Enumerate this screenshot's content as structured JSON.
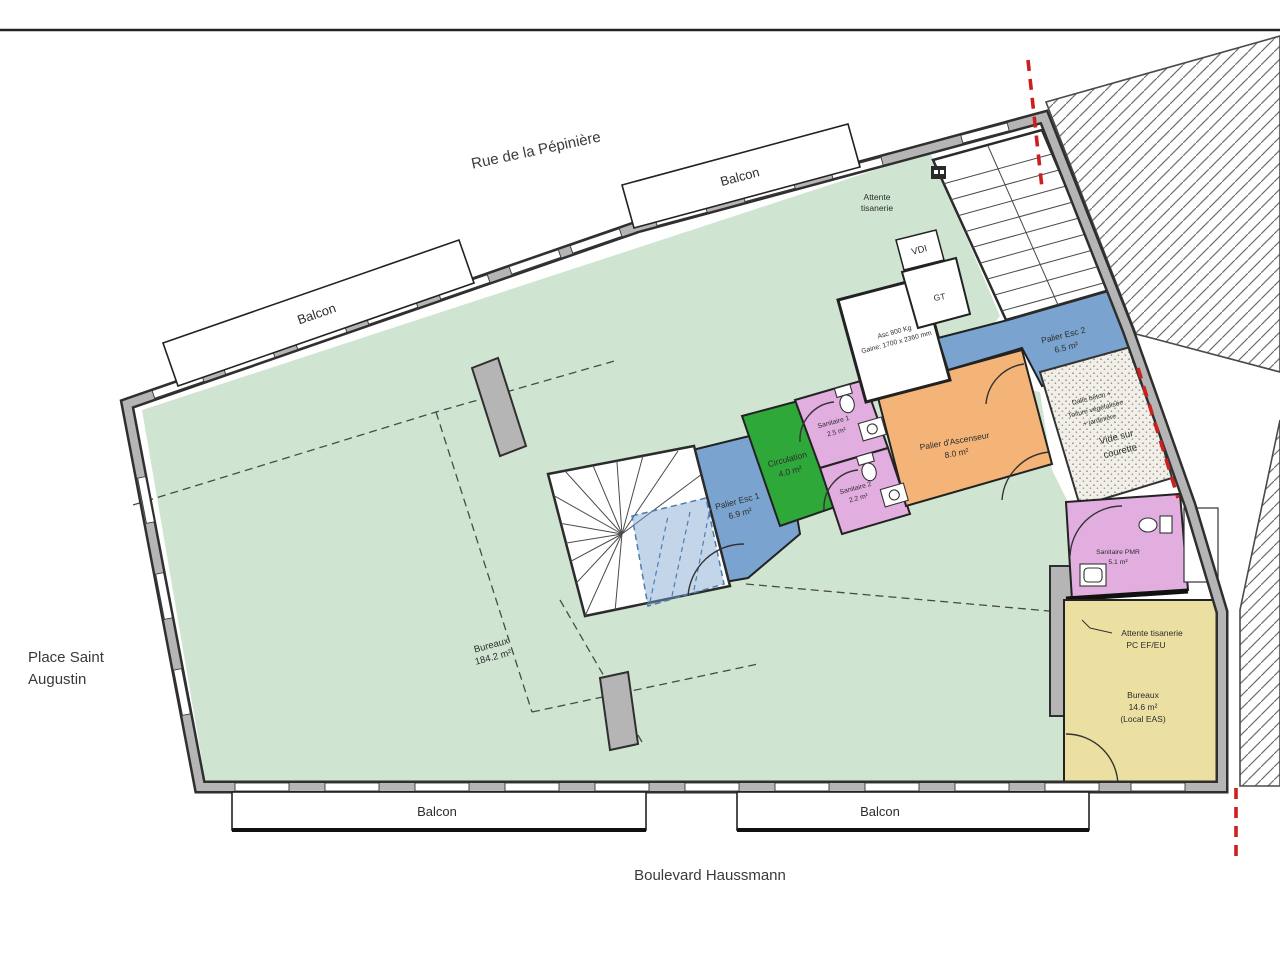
{
  "plan": {
    "streets": {
      "top": "Rue de la Pépinière",
      "left_line1": "Place Saint",
      "left_line2": "Augustin",
      "bottom": "Boulevard Haussmann"
    },
    "balcony_label": "Balcon",
    "rooms": {
      "bureaux_main": {
        "name": "Bureaux",
        "area": "184.2 m²"
      },
      "attente_tisanerie": {
        "line1": "Attente",
        "line2": "tisanerie"
      },
      "palier_esc_1": {
        "name": "Palier Esc 1",
        "area": "6.9 m²"
      },
      "circulation": {
        "name": "Circulation",
        "area": "4.0 m²"
      },
      "sanitaire_1": {
        "name": "Sanitaire 1",
        "area": "2.5 m²"
      },
      "sanitaire_2": {
        "name": "Sanitaire 2",
        "area": "2.2 m²"
      },
      "palier_ascenseur": {
        "name": "Palier d'Ascenseur",
        "area": "8.0 m²"
      },
      "ascenseur": {
        "line1": "Asc 800 Kg",
        "line2": "Gaine: 1700 x 2360 mm"
      },
      "gt": {
        "name": "GT"
      },
      "vdi": {
        "name": "VDI"
      },
      "palier_esc_2": {
        "name": "Palier Esc 2",
        "area": "6.5 m²"
      },
      "courette": {
        "note1": "Dalle béton +",
        "note2": "Toiture végétalisée",
        "note3": "+ jardinière",
        "name1": "Vide sur",
        "name2": "courette"
      },
      "sanitaire_pmr": {
        "name": "Sanitaire PMR",
        "area": "5.1 m²"
      },
      "bureaux_eas": {
        "name": "Bureaux",
        "area": "14.6 m²",
        "note": "(Local EAS)"
      },
      "attente_note": {
        "line1": "Attente tisanerie",
        "line2": "PC EF/EU"
      }
    },
    "colors": {
      "open_space": "#cfe5d1",
      "circulation": "#2fa83a",
      "stair_landing": "#7aa3cf",
      "sanitary": "#e2aee0",
      "elevator_landing": "#f4b377",
      "office_eas": "#ebe0a2",
      "wall_fill": "#b5b5b5",
      "wall_edge": "#2f2f2f",
      "boundary_red": "#cc2020"
    }
  }
}
